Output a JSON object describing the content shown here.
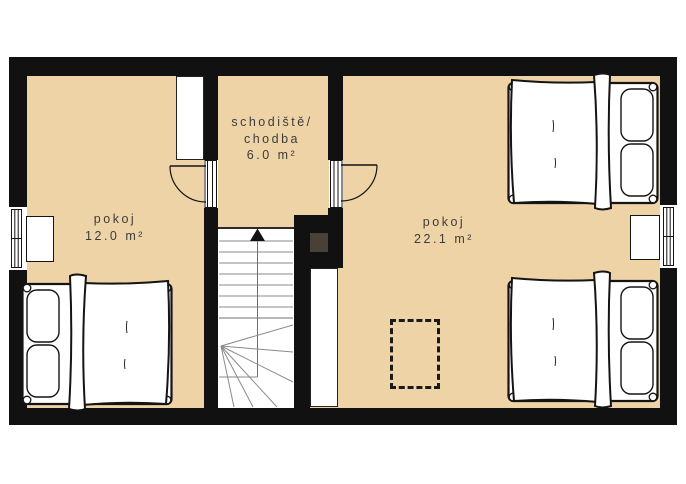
{
  "colors": {
    "floor": "#edd3a6",
    "wall": "#111111",
    "flue": "#494038",
    "text": "#3c3c3c",
    "paper": "#ffffff"
  },
  "rooms": {
    "left": {
      "name": "pokoj",
      "area": "12.0 m²"
    },
    "right": {
      "name": "pokoj",
      "area": "22.1 m²"
    },
    "hall": {
      "name_line1": "schodiště/",
      "name_line2": "chodba",
      "area": "6.0 m²"
    }
  }
}
